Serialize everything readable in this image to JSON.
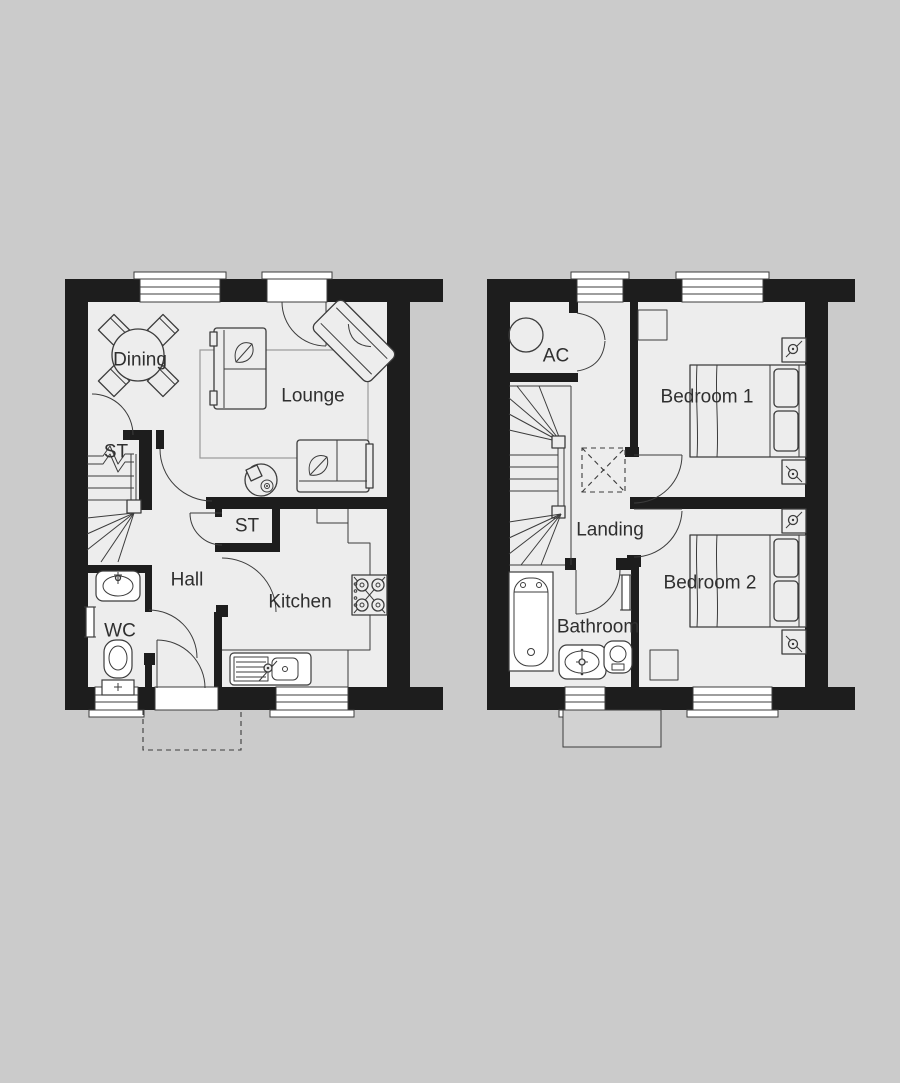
{
  "palette": {
    "background": "#cbcbcb",
    "floor": "#ededed",
    "wall": "#1d1d1d",
    "line": "#3c3c3c",
    "line_light": "#9a9a9a",
    "label": "#2f2f2f",
    "window": "#ffffff",
    "canopy_fill": "#d2d2d2"
  },
  "ground_floor": {
    "rooms": {
      "dining": "Dining",
      "lounge": "Lounge",
      "store_understairs": "ST",
      "store_hall": "ST",
      "hall": "Hall",
      "wc": "WC",
      "kitchen": "Kitchen"
    }
  },
  "first_floor": {
    "rooms": {
      "airing_cupboard": "AC",
      "bedroom_1": "Bedroom 1",
      "landing": "Landing",
      "bathroom": "Bathroom",
      "bedroom_2": "Bedroom 2"
    }
  }
}
